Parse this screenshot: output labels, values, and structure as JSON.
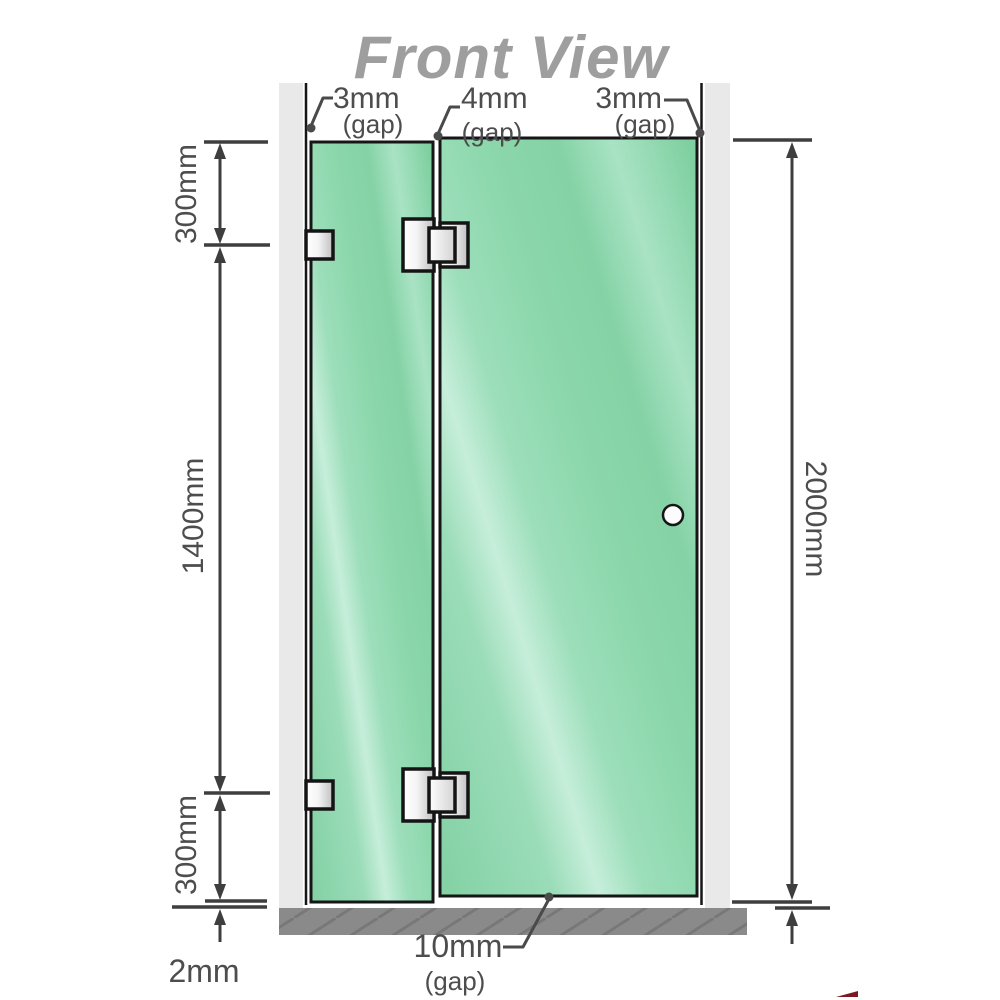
{
  "title": "Front View",
  "gap_labels": {
    "top_left": {
      "value": "3mm",
      "note": "(gap)"
    },
    "top_center": {
      "value": "4mm",
      "note": "(gap)"
    },
    "top_right": {
      "value": "3mm",
      "note": "(gap)"
    },
    "bottom": {
      "value": "10mm",
      "note": "(gap)"
    }
  },
  "dimension_labels": {
    "left_top": "300mm",
    "left_middle": "1400mm",
    "left_bottom": "300mm",
    "floor_clearance": "2mm",
    "overall_height": "2000mm"
  },
  "components": {
    "left_wall": "wall",
    "right_wall": "wall",
    "floor": "floor",
    "fixed_panel": "fixed glass panel",
    "door_panel": "hinged glass door",
    "hinge_count": 2,
    "wall_bracket_count": 2,
    "knob_count": 1
  },
  "colors": {
    "glass": "#8bd6ab",
    "glass_highlight": "#c6eeda",
    "wall": "#e9e9e9",
    "floor": "#8a8a8a",
    "outline": "#161616",
    "dimension_line": "#3e3e3e",
    "label_text": "#4d4d4d",
    "title_text": "#9e9e9e",
    "watermark_red": "#7c1822"
  }
}
